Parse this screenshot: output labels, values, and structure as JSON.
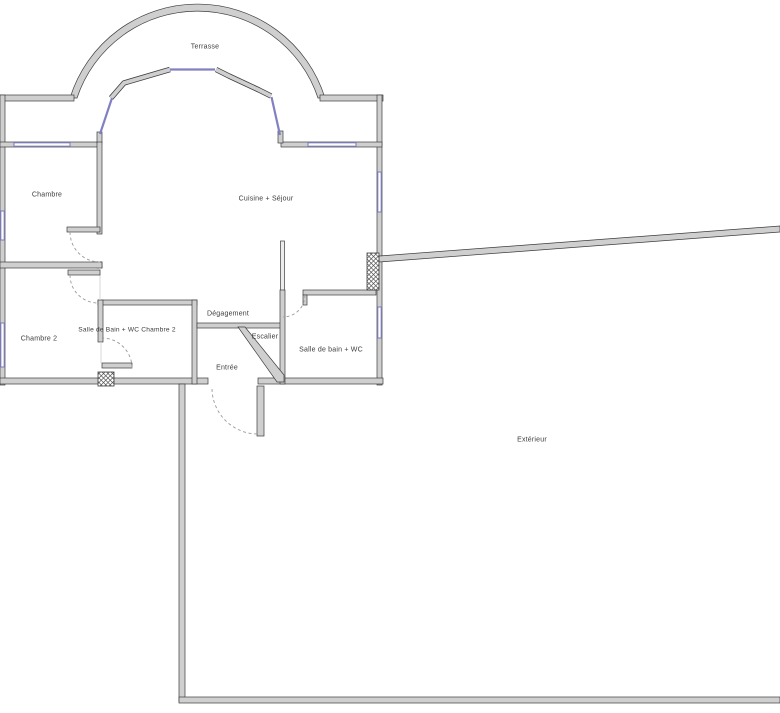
{
  "colors": {
    "wall_fill": "#cfcfcf",
    "wall_stroke": "#3d3d3d",
    "window_color": "#8181c2",
    "arc_color": "#9a9a9a",
    "label_color": "#3c3c3c"
  },
  "rooms": {
    "terrasse": {
      "label": "Terrasse"
    },
    "chambre": {
      "label": "Chambre"
    },
    "cuisine": {
      "label": "Cuisine + Séjour"
    },
    "chambre2": {
      "label": "Chambre 2"
    },
    "sdb_ch2": {
      "label": "Salle de Bain + WC Chambre 2"
    },
    "degagement": {
      "label": "Dégagement"
    },
    "escalier": {
      "label": "Escalier"
    },
    "entree": {
      "label": "Entrée"
    },
    "sdb_wc": {
      "label": "Salle de bain + WC"
    },
    "exterieur": {
      "label": "Extérieur"
    }
  }
}
